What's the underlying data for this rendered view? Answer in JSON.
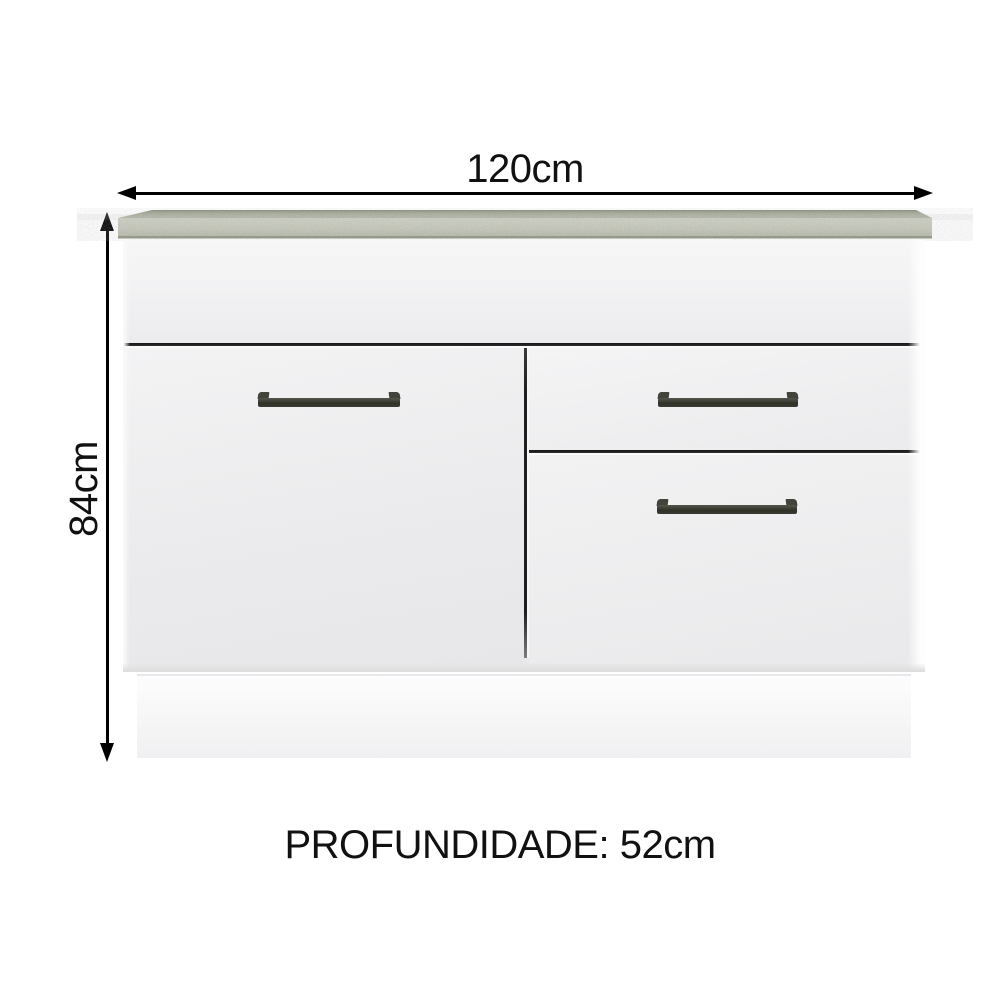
{
  "page": {
    "background": "#ffffff"
  },
  "dimensions": {
    "width": {
      "label": "120cm",
      "value_cm": 120
    },
    "height": {
      "label": "84cm",
      "value_cm": 84
    },
    "depth": {
      "label": "PROFUNDIDADE: 52cm",
      "value_cm": 52
    }
  },
  "cabinet": {
    "sections": [
      "fixed-top-panel",
      "left-door",
      "right-top-drawer",
      "right-bottom-drawer",
      "base-plinth"
    ],
    "handle_count": 3
  },
  "colors": {
    "arrow": "#000000",
    "text": "#111111",
    "countertop_top_surface": "#9fa594",
    "countertop_front_face": "#c3c6b8",
    "countertop_bottom_edge": "#959b8c",
    "body_face": "#eeeeef",
    "groove_dark": "#1e1e1e",
    "handle_dark": "#33352b",
    "plinth": "#f8f8fa"
  }
}
